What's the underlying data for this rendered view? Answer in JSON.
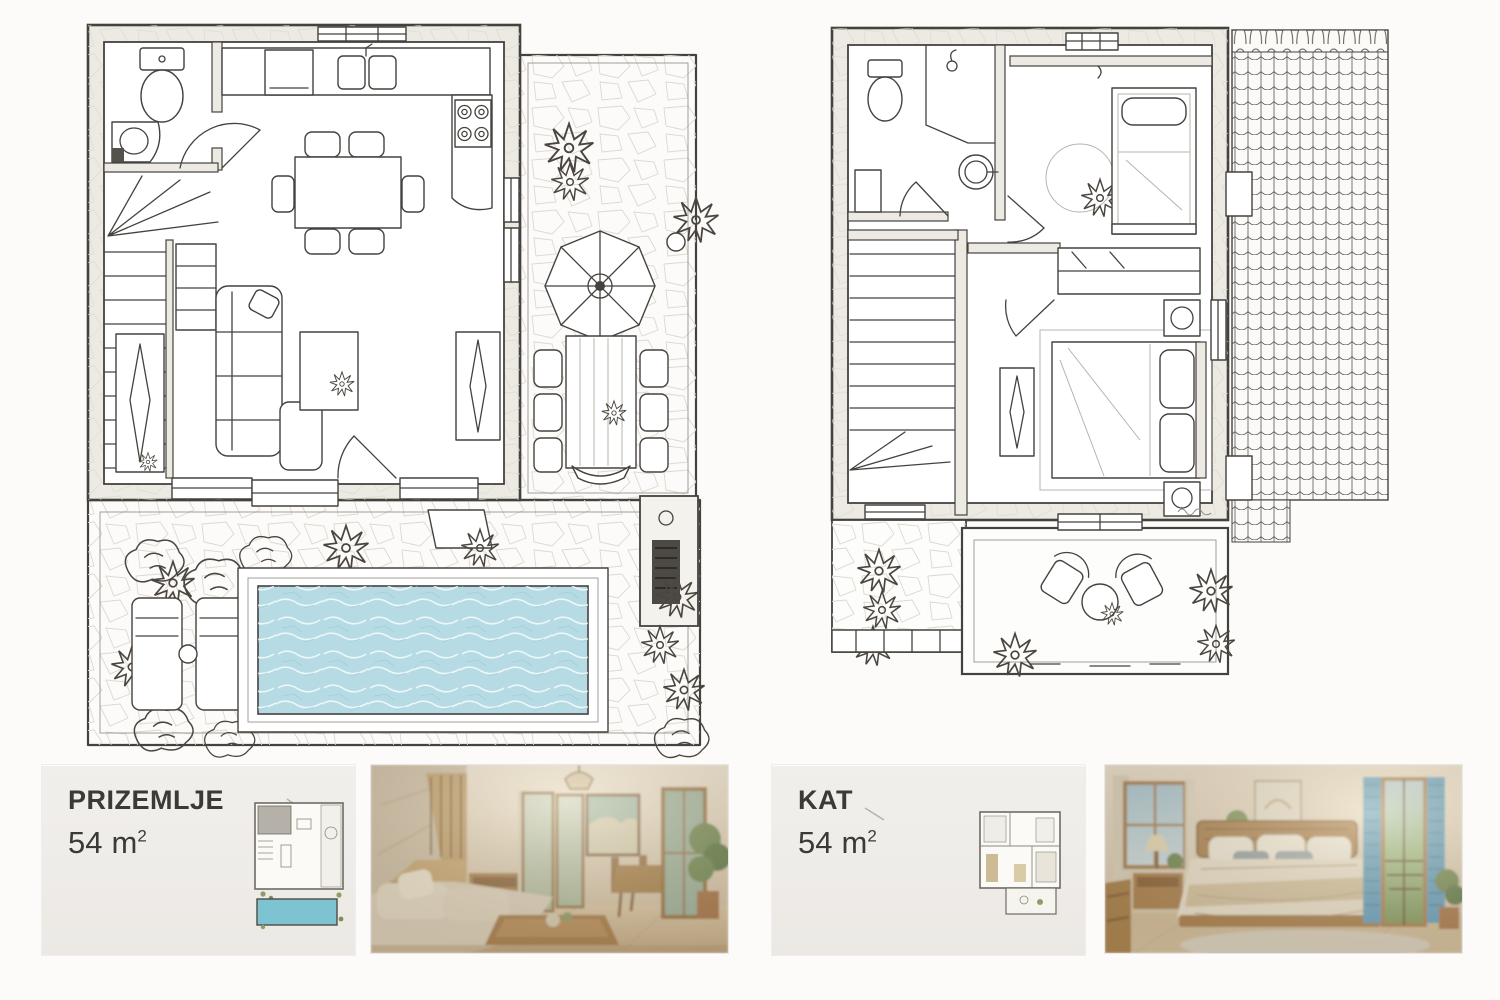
{
  "page": {
    "background": "#fcfbfa"
  },
  "colors": {
    "ink": "#45423e",
    "stone_line": "#ddd8cf",
    "wall_fill": "#eceae3",
    "pool_water": "#b7dbe4",
    "pool_highlight": "#e6f3f6",
    "roof_line": "#5a564f",
    "card_background": "#efedea",
    "text": "#3b3a37",
    "thumb_pool": "#7ec3d2",
    "photo_wood": "#a8814c",
    "photo_wall_beige": "#e3d7c2",
    "photo_sofa_beige": "#ddd2bd",
    "photo_shutter_blue": "#5fa0c4",
    "photo_plant_green": "#6f8a52"
  },
  "plans": [
    {
      "id": "ground-floor",
      "elements": [
        "wc-toilet",
        "wc-sink",
        "winder-staircase",
        "kitchen-counter",
        "kitchen-sink",
        "stove-4-burners",
        "dining-table-with-chairs",
        "l-shaped-sofa",
        "coffee-table",
        "sideboard",
        "entrance-door",
        "stone-terrace",
        "parasol",
        "outdoor-dining-table",
        "outdoor-chairs",
        "barbecue",
        "planters",
        "swimming-pool",
        "sun-loungers",
        "garden-shrubs"
      ]
    },
    {
      "id": "upper-floor",
      "elements": [
        "bathroom-toilet",
        "shower",
        "round-washbasin",
        "winder-staircase",
        "single-bed",
        "round-rug",
        "wardrobe",
        "double-bed",
        "nightstands-with-lamps",
        "dresser-with-mirror",
        "balcony",
        "balcony-armchairs",
        "balcony-round-table",
        "tiled-roof",
        "garden-shrubs"
      ]
    }
  ],
  "cards": [
    {
      "title": "PRIZEMLJE",
      "area_value": "54",
      "area_unit": "m",
      "area_exponent": "2"
    },
    {
      "title": "KAT",
      "area_value": "54",
      "area_unit": "m",
      "area_exponent": "2"
    }
  ]
}
